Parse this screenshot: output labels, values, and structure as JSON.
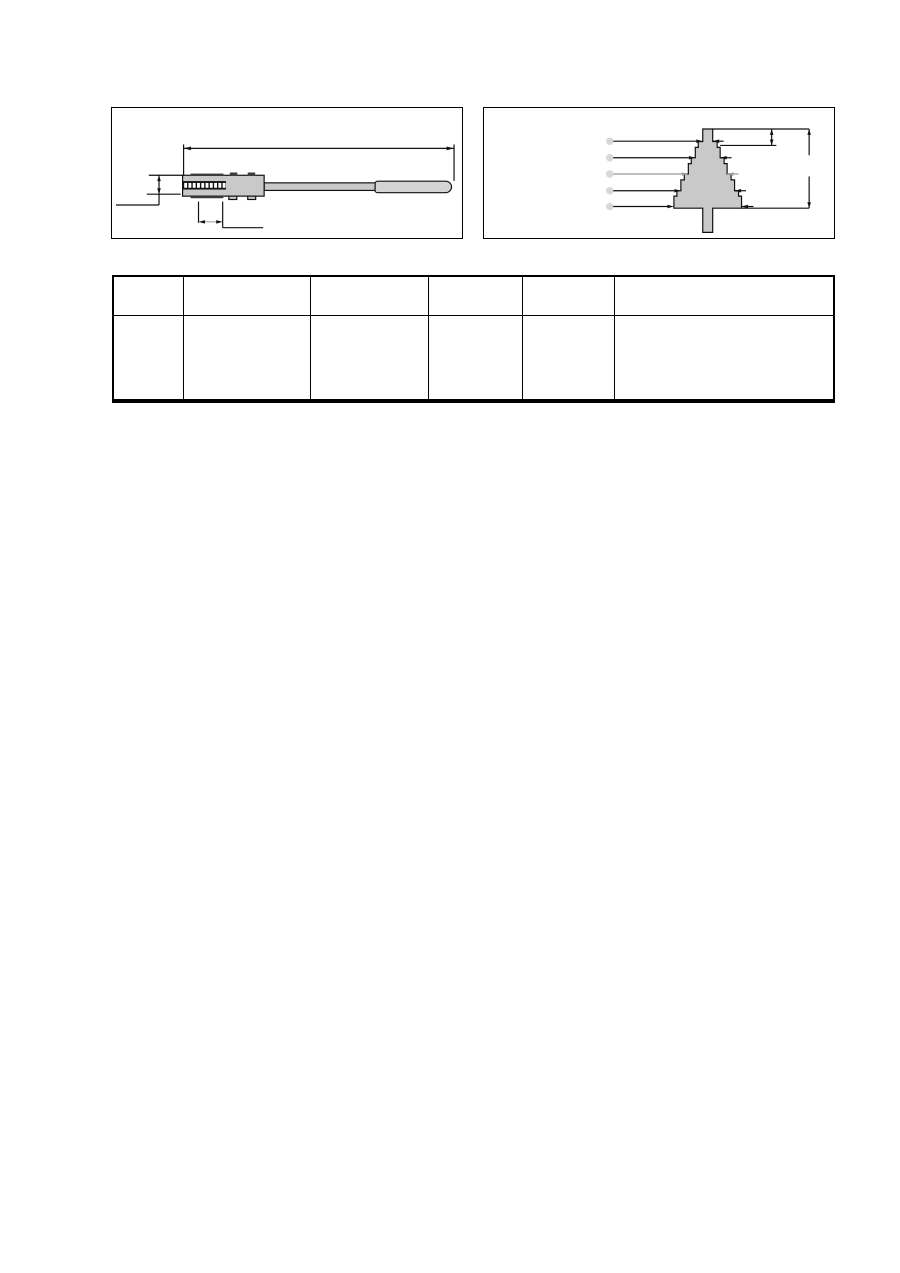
{
  "page": {
    "background": "#ffffff"
  },
  "colors": {
    "line": "#111111",
    "part_fill": "#c9c9c9",
    "handle_fill": "#d4d4d4",
    "teeth_band": "#111111",
    "teeth_fill": "#ffffff",
    "dark_detail": "#3a3a3a",
    "gray_leader": "#999999",
    "gray_dash": "#aaaaaa",
    "ghost_circle": "#d8d8d8",
    "table_border": "#000000"
  },
  "figure_left": {
    "kind": "technical-drawing",
    "subject": "handled-file-tool-side-view",
    "dimensions_shown": [
      "overall-length-top",
      "body-height-left",
      "tooth-section-width-bottom"
    ]
  },
  "figure_right": {
    "kind": "technical-drawing",
    "subject": "stepped-cone-gauge-front-view",
    "leader_lines": 5,
    "dimensions_shown": [
      "step-height-right-short",
      "overall-height-right-long",
      "five-step-width-leaders"
    ]
  },
  "table": {
    "headers": [
      "",
      "",
      "",
      "",
      "",
      ""
    ],
    "rows": [
      [
        "",
        "",
        "",
        "",
        "",
        ""
      ]
    ]
  }
}
